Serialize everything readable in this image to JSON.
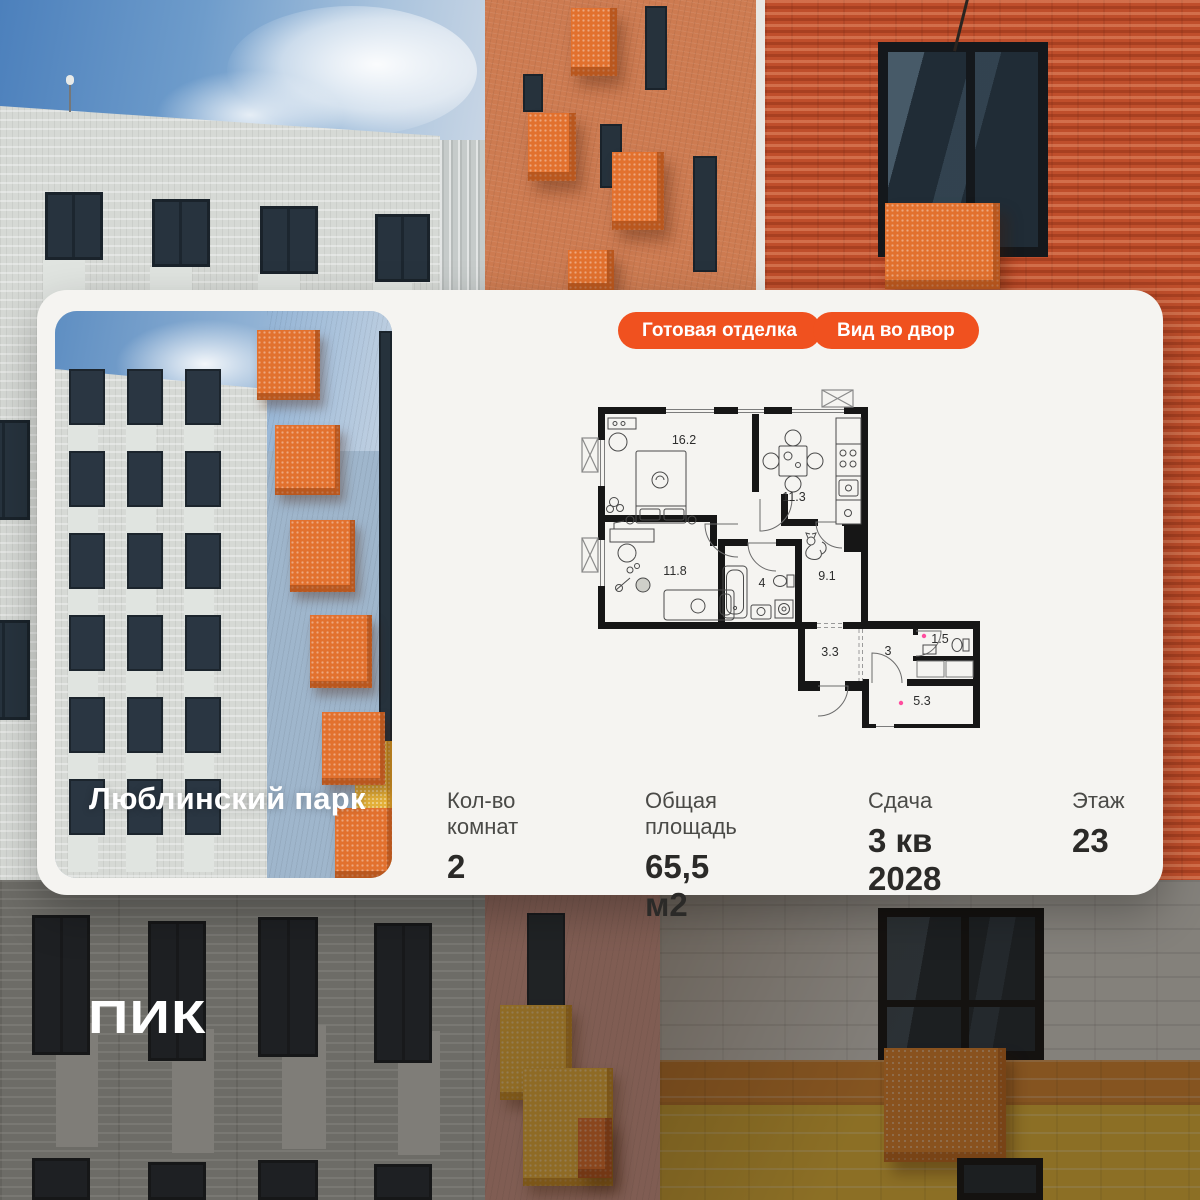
{
  "card": {
    "badges": [
      {
        "label": "Готовая отделка"
      },
      {
        "label": "Вид во двор"
      }
    ],
    "project": "Люблинский парк",
    "stats": [
      {
        "label": "Кол-во комнат",
        "value": "2"
      },
      {
        "label": "Общая площадь",
        "value": "65,5 м2"
      },
      {
        "label": "Сдача",
        "value": "3 кв 2028"
      },
      {
        "label": "Этаж",
        "value": "23"
      }
    ]
  },
  "floorplan": {
    "rooms": [
      {
        "name": "living-room",
        "area": "16.2"
      },
      {
        "name": "kitchen",
        "area": "11.3"
      },
      {
        "name": "bedroom",
        "area": "11.8"
      },
      {
        "name": "bathroom",
        "area": "4"
      },
      {
        "name": "hallway",
        "area": "9.1"
      },
      {
        "name": "corridor",
        "area": "3.3"
      },
      {
        "name": "hall",
        "area": "3"
      },
      {
        "name": "wc",
        "area": "1.5"
      },
      {
        "name": "room",
        "area": "5.3"
      }
    ]
  },
  "logo": "ПИК",
  "colors": {
    "accent": "#F0511F",
    "pink_dot": "#FF4D9E",
    "card_bg": "#F5F4F1",
    "wall": "#161616"
  }
}
